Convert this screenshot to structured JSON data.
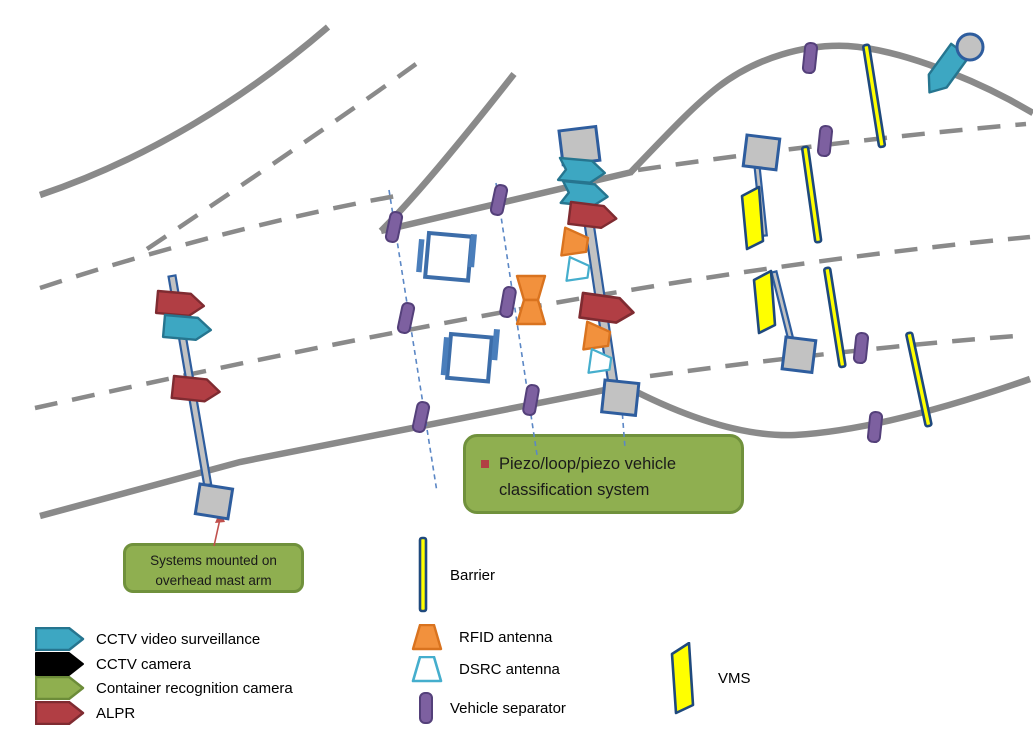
{
  "colors": {
    "road": "#8A8A8A",
    "lane": "#8A8A8A",
    "cctv_teal": "#3DA7C2",
    "cctv_teal_border": "#26758F",
    "alpr_red": "#B13E44",
    "alpr_red_border": "#7F2B31",
    "container_green": "#8FAF4F",
    "container_green_border": "#6C8C39",
    "cctv_black": "#000000",
    "rfid_orange": "#F2913D",
    "rfid_orange_border": "#D9731F",
    "dsrc_blue": "#45AECD",
    "separator_purple": "#7D60A0",
    "separator_purple_border": "#54407A",
    "barrier_yellow": "#FFFF00",
    "barrier_blue": "#1F497D",
    "vms_yellow": "#FFFF00",
    "loop_blue": "#3C6DA9",
    "piezo_blue": "#4A7EBB",
    "structure_gray": "#C2C2C2",
    "structure_blue": "#2E5D9E",
    "leader_blue": "#5B87C5",
    "callout_fill": "#8FAF50",
    "callout_border": "#70913C",
    "callout_text": "#1A1A1A",
    "annotation_red": "#C0504D"
  },
  "callouts": {
    "piezo_classification": "Piezo/loop/piezo vehicle classification system",
    "mast_mounted": "Systems mounted on overhead mast arm"
  },
  "legend": {
    "cctv_video": "CCTV video surveillance",
    "cctv_camera": "CCTV camera",
    "container_camera": "Container recognition camera",
    "alpr": "ALPR",
    "barrier": "Barrier",
    "rfid": "RFID antenna",
    "dsrc": "DSRC antenna",
    "separator": "Vehicle separator",
    "vms": "VMS"
  }
}
